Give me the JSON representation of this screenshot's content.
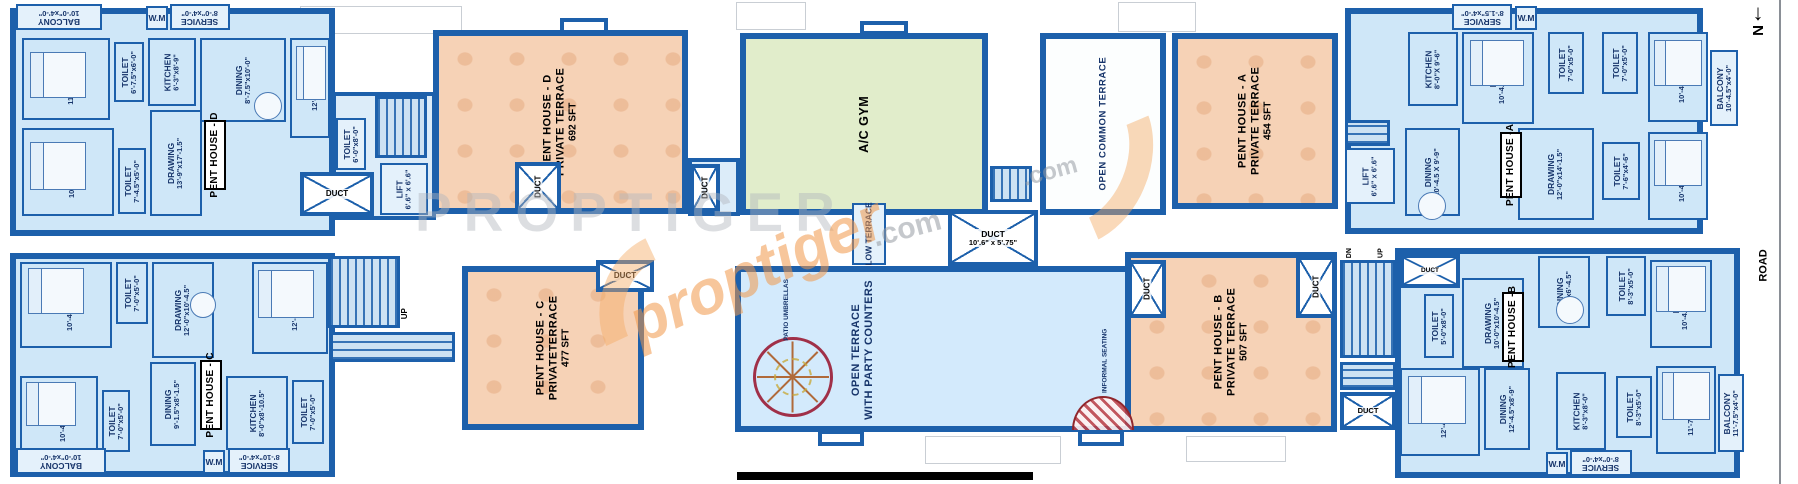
{
  "compass": {
    "arrow": "↓",
    "label": "N"
  },
  "road": "ROAD",
  "colors": {
    "wall": "#1d60ab",
    "room": "#cfe7f8",
    "terrace": "#f6d2b6",
    "gym": "#e1edcb",
    "open_terrace": "#d3eafc"
  },
  "watermark": {
    "gray": "PROPTIGER",
    "orange": "proptiger",
    "com": ".com"
  },
  "shared": {
    "duct": "DUCT",
    "duct_dim": "10'.6\" x 5'.75\"",
    "lift": "LIFT",
    "lift_dim": "6'.6\" x 6'.6\"",
    "up": "UP",
    "dn": "DN",
    "low_terrace": "LOW TERRACE",
    "open_common": "OPEN COMMON TERRACE",
    "gym": "A/C GYM",
    "open_terrace1": "OPEN TERRACE",
    "open_terrace2": "WITH PARTY COUNTERS",
    "patio": "PATIO UMBRELLAS",
    "informal": "INFORMAL SEATING"
  },
  "terraces": {
    "d": {
      "name": "PENT HOUSE - D",
      "type": "PRIVATE TERRACE",
      "area": "692  SFT"
    },
    "a": {
      "name": "PENT HOUSE - A",
      "type": "PRIVATE TERRACE",
      "area": "454  SFT"
    },
    "c": {
      "name": "PENT HOUSE - C",
      "type": "PRIVATETERRACE",
      "area": "477  SFT"
    },
    "b": {
      "name": "PENT HOUSE - B",
      "type": "PRIVATE TERRACE",
      "area": "507  SFT"
    }
  },
  "unitD": {
    "tag": "PENT HOUSE - D",
    "rooms": [
      {
        "n": "BALCONY",
        "d": "10'-0\"x4'-0\""
      },
      {
        "n": "W.M",
        "d": ""
      },
      {
        "n": "SERVICE",
        "d": "8'-0\"x4'-0\""
      },
      {
        "n": "BED",
        "d": "11'-7.5\"x10'-0\""
      },
      {
        "n": "TOILET",
        "d": "6'-7.5\"x6'-0\""
      },
      {
        "n": "KITCHEN",
        "d": "6'-3\"x8'-9\""
      },
      {
        "n": "DINING",
        "d": "8'-7.5\"x10'-0\""
      },
      {
        "n": "BED",
        "d": "12'-0\"x10'-0\""
      },
      {
        "n": "BED",
        "d": "10'-4.5\"x12'-0\""
      },
      {
        "n": "TOILET",
        "d": "7'-4.5\"x5'-0\""
      },
      {
        "n": "DRAWING",
        "d": "13'-9\"x17'-1.5\""
      },
      {
        "n": "TOILET",
        "d": "6'-0\"x8'-0\""
      }
    ]
  },
  "unitA": {
    "tag": "PENT HOUSE -A",
    "rooms": [
      {
        "n": "SERVICE",
        "d": "8'-1.5\"x4'-0\""
      },
      {
        "n": "W.M",
        "d": ""
      },
      {
        "n": "KITCHEN",
        "d": "8'-0\"X 9'-6\""
      },
      {
        "n": "BED",
        "d": "10'-4.5\"x12'-0\""
      },
      {
        "n": "TOILET",
        "d": "7'-0\"x5'-0\""
      },
      {
        "n": "TOILET",
        "d": "7'-0\"x5'-0\""
      },
      {
        "n": "BED",
        "d": "10'-4.5\"x12'-0\""
      },
      {
        "n": "BALCONY",
        "d": "10'-4.5\"x4'-0\""
      },
      {
        "n": "BED",
        "d": "10'-4.5\"x12'-0\""
      },
      {
        "n": "TOILET",
        "d": "7'-6\"x4'-6\""
      },
      {
        "n": "DRAWING",
        "d": "12'-0\"x14'-1.5\""
      },
      {
        "n": "DINING",
        "d": "10'-4.5 X 9'-9\""
      }
    ]
  },
  "unitC": {
    "tag": "PENT HOUSE - C",
    "rooms": [
      {
        "n": "BED",
        "d": "10'-4.5\"x12'-0\""
      },
      {
        "n": "TOILET",
        "d": "7'-0\"x5'-0\""
      },
      {
        "n": "DRAWING",
        "d": "12'-0\"x10'-4.5\""
      },
      {
        "n": "BED",
        "d": "12'-0\"x10'-0\""
      },
      {
        "n": "DINING",
        "d": "9'-1.5\"x8'-1.5\""
      },
      {
        "n": "BED",
        "d": "10'-4.5\"x12'-0\""
      },
      {
        "n": "TOILET",
        "d": "7'-0\"x5'-0\""
      },
      {
        "n": "KITCHEN",
        "d": "8'-0\"x8'-10.5\""
      },
      {
        "n": "TOILET",
        "d": "7'-0\"x5'-0\""
      },
      {
        "n": "BALCONY",
        "d": "10'-0\"x4'-0\""
      },
      {
        "n": "W.M",
        "d": ""
      },
      {
        "n": "SERVICE",
        "d": "8'-10\"x4'-0\""
      }
    ]
  },
  "unitB": {
    "tag": "PENT HOUSE -B",
    "rooms": [
      {
        "n": "TOILET",
        "d": "5'-0\"x8'-0\""
      },
      {
        "n": "DRAWING",
        "d": "10'-0\"x10'-4.5\""
      },
      {
        "n": "DINING",
        "d": "9'-3\"x6'-4.5\""
      },
      {
        "n": "TOILET",
        "d": "8'-3\"x5'-0\""
      },
      {
        "n": "BED",
        "d": "10'-4.5\"x12'-0\""
      },
      {
        "n": "BED",
        "d": "12'-4.5\"x10'-0\""
      },
      {
        "n": "DINING",
        "d": "12'-4.5\"x8'-9\""
      },
      {
        "n": "KITCHEN",
        "d": "8'-3\"x8'-0\""
      },
      {
        "n": "TOILET",
        "d": "8'-3\"x5'-0\""
      },
      {
        "n": "BED",
        "d": "11'-7.5\"x12'-0\""
      },
      {
        "n": "BALCONY",
        "d": "11'-7.5\"x4'-0\""
      },
      {
        "n": "W.M",
        "d": ""
      },
      {
        "n": "SERVICE",
        "d": "8'-0\"x4'-0\""
      }
    ]
  }
}
